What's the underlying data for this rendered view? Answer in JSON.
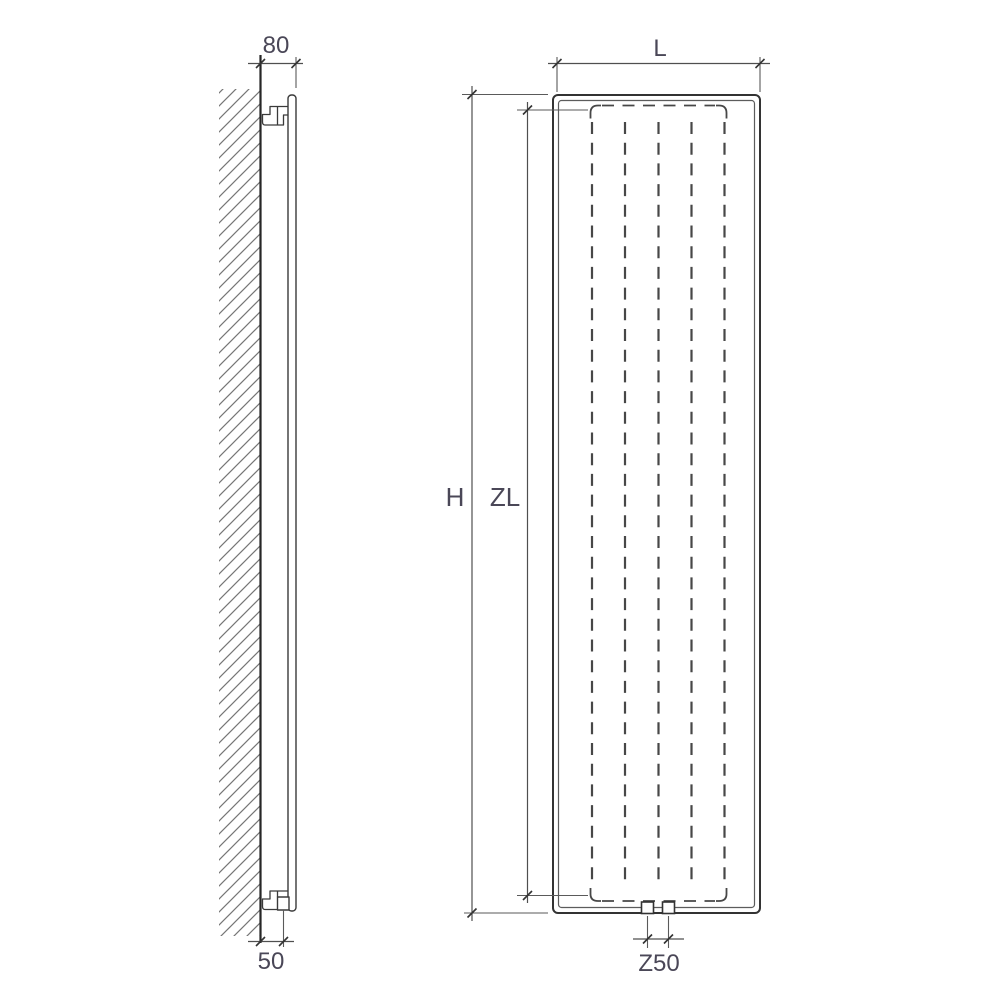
{
  "drawing": {
    "kind": "radiator dimension drawing (side view and front view)",
    "labels": {
      "depth": "80",
      "wall_to_pipe": "50",
      "width": "L",
      "height": "H",
      "element_height": "ZL",
      "pipe_spacing": "Z50"
    },
    "colors": {
      "background": "#ffffff",
      "outline": "#333333",
      "inner_line": "#5c5c5c",
      "dashed_element": "#474747",
      "wall_face": "#262626",
      "hatch": "#757575",
      "dimension_line": "#4f4f4f",
      "label_text": "#4a4757"
    }
  }
}
